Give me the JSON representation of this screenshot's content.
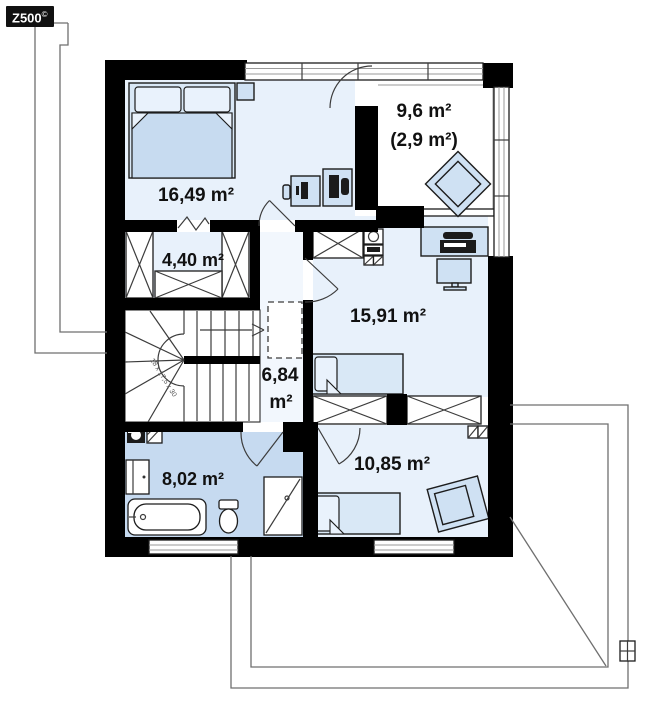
{
  "logo": {
    "brand": "Z500",
    "mark": "©"
  },
  "floor_plan": {
    "rooms": [
      {
        "id": "bedroom-1",
        "label": "16,49 m²"
      },
      {
        "id": "attic-space",
        "label": "9,6 m²",
        "label2": "(2,9 m²)"
      },
      {
        "id": "wardrobe",
        "label": "4,40 m²"
      },
      {
        "id": "bedroom-2",
        "label": "15,91 m²"
      },
      {
        "id": "hall",
        "label_value": "6,84",
        "label_unit": "m²"
      },
      {
        "id": "bathroom",
        "label": "8,02 m²"
      },
      {
        "id": "bedroom-3",
        "label": "10,85 m²"
      }
    ],
    "stairs": {
      "dimensions_note": "18 x 17,5 x 30"
    }
  },
  "icons": {
    "double-bed": "rect-with-pillows",
    "single-bed": "rect-with-pillow",
    "nightstand": "small-square",
    "desk-chair": "small-rounded-rect",
    "desk-with-monitor": "rect-with-dark-glyph",
    "computer-desk": "rect-with-dark-glyphs",
    "printer-desk": "rect-with-dark-printer",
    "computer-monitor": "rect-with-stand",
    "armchair": "nested-rotated-squares",
    "wardrobe-unit": "crossed-rect",
    "sink-unit": "square-with-circle",
    "vent-grille": "hatched-squares",
    "washing-machine": "dark-square-with-circle",
    "washbasin-cabinet": "split-rect",
    "bathtub": "rounded-rect-oval",
    "toilet": "tank-and-bowl",
    "shower-cabin": "square-with-diagonal",
    "staircase": "treads-winders-arrow",
    "door": "quarter-arc-leaf",
    "window": "triple-line-band",
    "roof-outline": "thin-polyline",
    "chimney": "small-gridded-square"
  },
  "colors": {
    "wall": "#000000",
    "room_fill": "#e8f1fb",
    "bath_fill": "#c6daf0",
    "hall_fill": "#f2f7fd",
    "furniture_fill": "#cfe1f3",
    "furniture_stroke": "#1c1c1c",
    "thin_line": "#3c3c3c",
    "roof_line": "#6f6f6f",
    "label_color": "#111111",
    "logo_bg": "#111111",
    "logo_color": "#ffffff"
  }
}
